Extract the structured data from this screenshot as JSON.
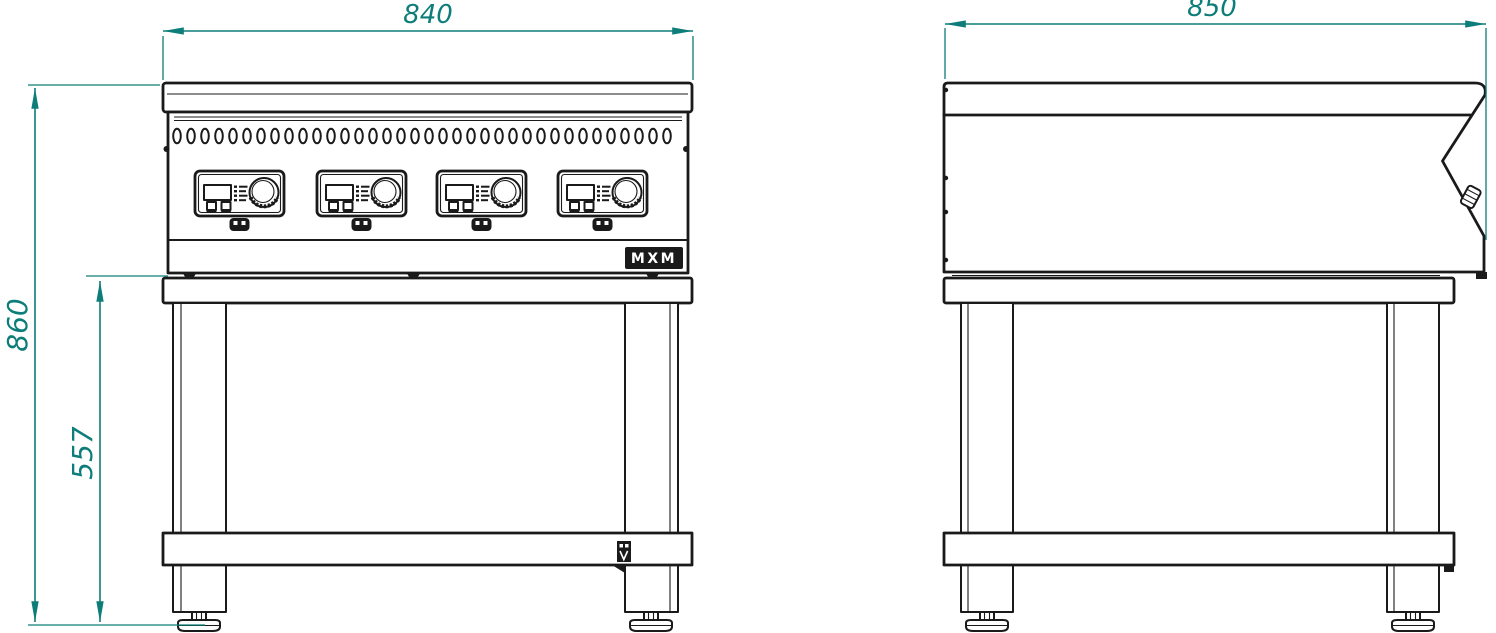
{
  "drawing": {
    "subject": "Four-zone induction range on open stand - front and side elevation technical drawing",
    "colors": {
      "line": "#1a1a1a",
      "dimension": "#0d7d79",
      "background": "#ffffff"
    },
    "dimensions": {
      "front_width": "840",
      "side_depth": "850",
      "overall_height": "860",
      "stand_height": "557"
    },
    "front_view": {
      "vent_slot_count": 36
    },
    "logo": {
      "text": "MXM"
    }
  }
}
